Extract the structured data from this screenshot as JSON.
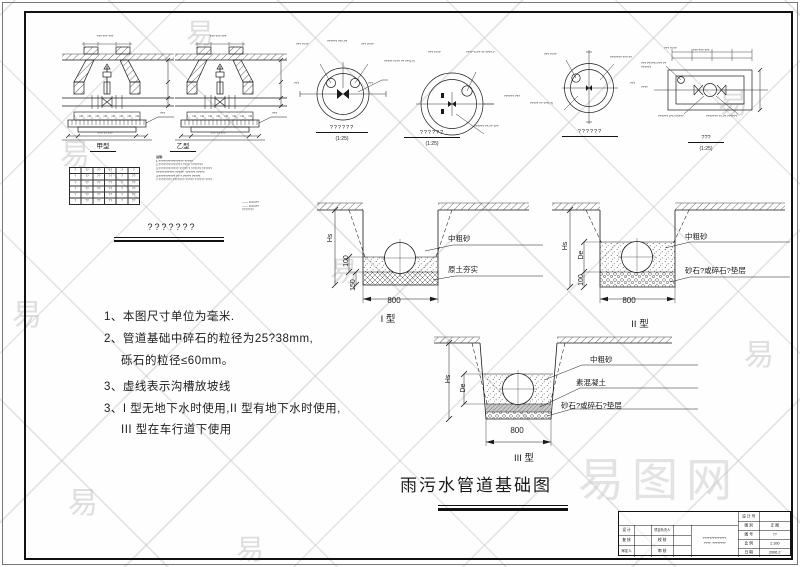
{
  "page": {
    "main_title": "雨污水管道基础图"
  },
  "watermark": {
    "glyph": "易",
    "big": "易图网"
  },
  "wells": {
    "caption_a": "甲型",
    "caption_b": "乙型",
    "group_title": "???????",
    "notes_title": "说明:",
    "notes": [
      "1.???????????????  ?????.",
      "2.??????????????  ????. ???????",
      "3.???????????? ????? ?.??????.??????",
      "   ???????????.?????. ??????  ?????.",
      "4.??????????  ?? ?.????? ?????.",
      "?   ????????.???????·????? ??????   ????."
    ],
    "legend": [
      "—— 0.2m??",
      "—— 0.2m??",
      "???????"
    ],
    "micro": [
      "??? ??? ???",
      "??? ?? ???",
      "???"
    ],
    "table": {
      "header": [
        "?",
        "??",
        "??",
        "??",
        "?",
        "?"
      ],
      "rows": [
        [
          "?",
          "??",
          "??",
          "??",
          "?",
          "??"
        ],
        [
          "?",
          "??",
          "??",
          "??",
          "?",
          "??"
        ],
        [
          "?",
          "??",
          "??",
          "??",
          "?",
          "??"
        ],
        [
          "?",
          "??",
          "??",
          "??",
          "?",
          "??"
        ],
        [
          "?",
          "??",
          "??",
          "??",
          "?",
          "??"
        ]
      ]
    }
  },
  "plans": {
    "c1": {
      "caption": "??????",
      "scale": "(1:25)",
      "ann": [
        "??? ?=??",
        "?????? ???-??",
        "??? ?=??",
        "????? ?=?? ?? ???(-?)",
        "???",
        "???"
      ]
    },
    "c2": {
      "caption": "??????",
      "scale": "(1:25)",
      "ann": [
        "??? ?=??",
        "???? ?=?? ?? ????-?",
        "?????? ???",
        "?????? ??-?? ???"
      ]
    },
    "c3": {
      "caption": "??????",
      "ann": [
        "??? ?=??",
        "??????? ???-??",
        "????? ?? ???(-?)",
        "???"
      ]
    },
    "r4": {
      "caption": "???",
      "scale": "(1:25)",
      "ann": [
        "??? ?=??",
        "??? ?????×??? ?? ??????",
        "????",
        "?????? (??-??)???",
        "??????? ??-?? ??????",
        "??? ??? ???"
      ]
    }
  },
  "sections": {
    "dim_hs": "Hs",
    "dim_de": "De",
    "dim_100": "100",
    "dim_150": "150",
    "dim_800": "800",
    "t1": {
      "caption": "I  型",
      "labels": [
        "中粗砂",
        "原土夯实"
      ]
    },
    "t2": {
      "caption": "II  型",
      "labels": [
        "中粗砂",
        "砂石?或碎石?垫层"
      ]
    },
    "t3": {
      "caption": "III  型",
      "labels": [
        "中粗砂",
        "素混凝土",
        "砂石?或碎石?垫层"
      ]
    }
  },
  "notes_main": {
    "lines": [
      "1、本图尺寸单位为毫米.",
      "2、管道基础中碎石的粒径为25?38mm,",
      "砾石的粒径≤60mm。",
      "3、虚线表示沟槽放坡线",
      "3、I 型无地下水时使用,II 型有地下水时使用,",
      "III 型在车行道下使用"
    ]
  },
  "titleblock": {
    "r1l": "设 计 号",
    "r1v": "",
    "r2l": "图 别",
    "r2v": "正 图",
    "r3l": "图 号",
    "r3v": "??",
    "r4l": "比 例",
    "r4v": "1:100",
    "r5l": "日 期",
    "r5v": "2006.2",
    "l1": "设 计",
    "l2": "复 核",
    "l3": "审定人",
    "m1": "项目负责人",
    "m2": "校 核",
    "m3": "审 核",
    "p1": "??????????????,",
    "p2": "????, ????????"
  }
}
